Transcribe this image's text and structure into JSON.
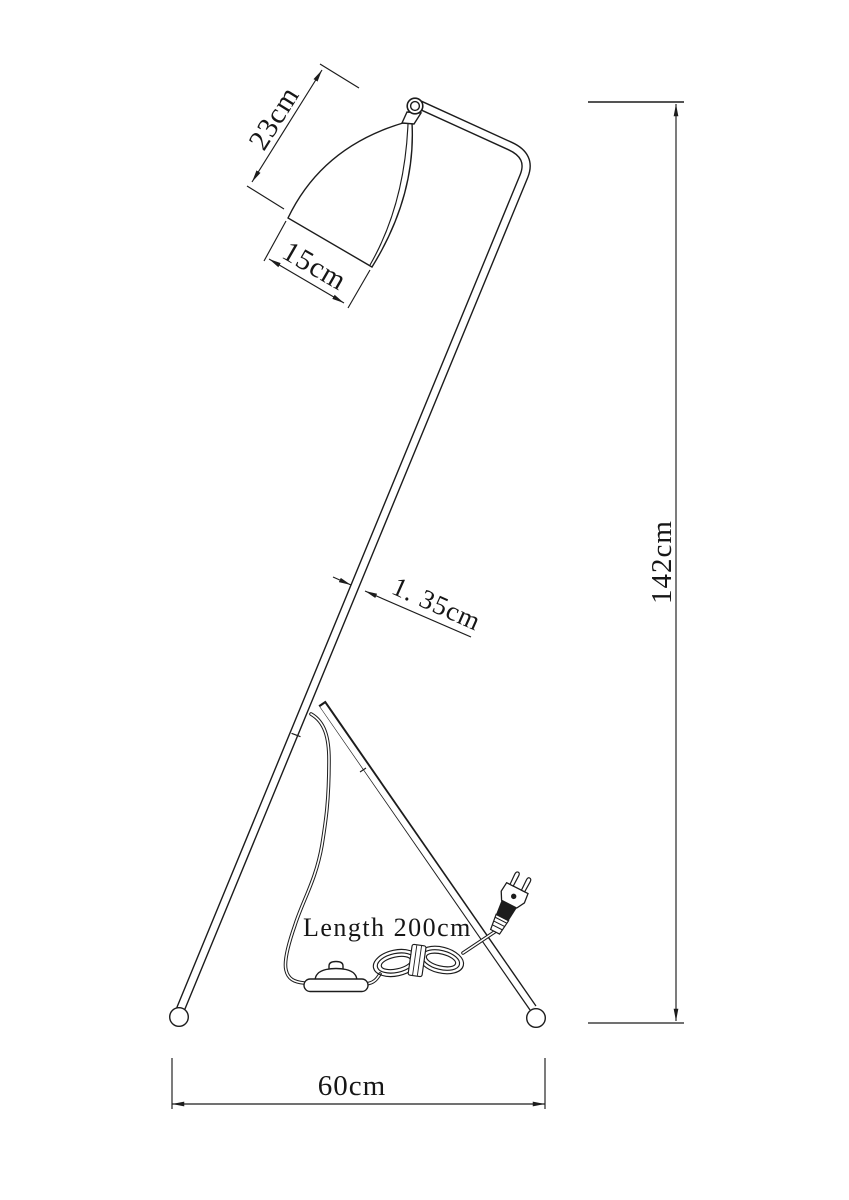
{
  "page": {
    "background": "#ffffff"
  },
  "drawing": {
    "line_color": "#1c1c1c",
    "dimension_color": "#161616",
    "subject": "tripod floor lamp with conical shade, power cord, foot switch and plug"
  },
  "labels": {
    "shade_height": "23cm",
    "shade_opening_width": "15cm",
    "tube_diameter": "1. 35cm",
    "overall_height": "142cm",
    "base_width": "60cm",
    "cord_length": "Length 200cm"
  }
}
